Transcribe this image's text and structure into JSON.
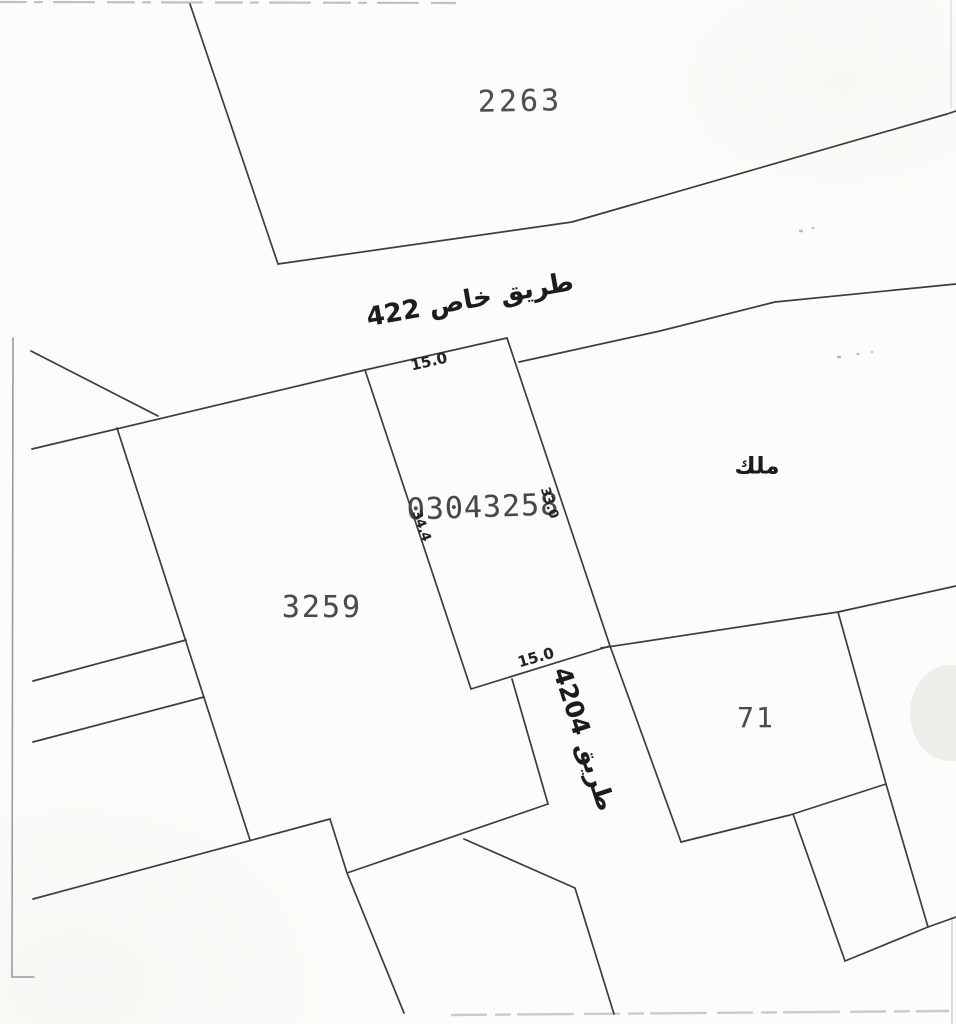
{
  "document": {
    "type": "cadastral-survey-sketch",
    "background": "#fcfcfa",
    "line_color": "#3d3d3d",
    "line_width": 1.7,
    "artifact_color": "#8e8e8e"
  },
  "map": {
    "parcels": [
      {
        "id": "2263"
      },
      {
        "id": "3259"
      },
      {
        "id": "71"
      },
      {
        "id": "03043258"
      }
    ],
    "roads": [
      {
        "label_ar": "طريق خاص",
        "number": "422"
      },
      {
        "label_ar": "طريق",
        "number": "4204"
      }
    ],
    "ownership_note_ar": "ملك",
    "dimensions_m": {
      "top": "15.0",
      "bottom": "15.0",
      "west": "34.4",
      "east": "33.0"
    },
    "labels": [
      {
        "name": "parcel-2263-label",
        "text": "2263",
        "x": 520,
        "y": 102,
        "rotate": -1,
        "size": 30,
        "spacing": 3,
        "color": "#4f4f4f",
        "mono": true
      },
      {
        "name": "road-422-label",
        "text": "طريق خاص 422",
        "x": 470,
        "y": 300,
        "rotate": -10,
        "size": 26,
        "bold": true,
        "rtl": true,
        "color": "#1c1c1c"
      },
      {
        "name": "dim-top-width-label",
        "text": "15.0",
        "x": 429,
        "y": 362,
        "rotate": -13,
        "size": 15,
        "bold": true,
        "color": "#222222"
      },
      {
        "name": "parcel-03043258-label",
        "text": "03043258",
        "x": 483,
        "y": 508,
        "rotate": -2,
        "size": 30,
        "spacing": 1,
        "color": "#484848",
        "mono": true
      },
      {
        "name": "dim-west-length-label",
        "text": "34.4",
        "x": 421,
        "y": 526,
        "rotate": 70,
        "size": 13,
        "bold": true,
        "color": "#222222"
      },
      {
        "name": "dim-east-length-label",
        "text": "33.0",
        "x": 549,
        "y": 503,
        "rotate": 72,
        "size": 13,
        "bold": true,
        "color": "#222222"
      },
      {
        "name": "melk-ownership-label",
        "text": "ملك",
        "x": 757,
        "y": 467,
        "rotate": 0,
        "size": 23,
        "bold": true,
        "rtl": true,
        "color": "#1c1c1c"
      },
      {
        "name": "parcel-3259-label",
        "text": "3259",
        "x": 322,
        "y": 608,
        "rotate": 0,
        "size": 30,
        "spacing": 2,
        "color": "#4b4b4b",
        "mono": true
      },
      {
        "name": "dim-bottom-width-label",
        "text": "15.0",
        "x": 536,
        "y": 658,
        "rotate": -16,
        "size": 15,
        "bold": true,
        "color": "#222222"
      },
      {
        "name": "road-4204-label",
        "text": "طريق 4204",
        "x": 584,
        "y": 739,
        "rotate": 72,
        "size": 25,
        "bold": true,
        "rtl": true,
        "color": "#1c1c1c"
      },
      {
        "name": "parcel-71-label",
        "text": "71",
        "x": 756,
        "y": 718,
        "rotate": 0,
        "size": 28,
        "spacing": 2,
        "color": "#4b4b4b",
        "mono": true
      }
    ],
    "boundaries": [
      {
        "name": "parcel-2263-west-edge",
        "points": [
          [
            190,
            4
          ],
          [
            278,
            264
          ]
        ]
      },
      {
        "name": "parcel-2263-south-boundary",
        "points": [
          [
            278,
            264
          ],
          [
            572,
            222
          ],
          [
            947,
            114
          ],
          [
            956,
            111
          ]
        ]
      },
      {
        "name": "northwest-spur-line",
        "points": [
          [
            31,
            351
          ],
          [
            158,
            416
          ]
        ]
      },
      {
        "name": "west-block-north-boundary",
        "points": [
          [
            32,
            449
          ],
          [
            365,
            370
          ]
        ]
      },
      {
        "name": "plot-top-edge",
        "points": [
          [
            365,
            370
          ],
          [
            507,
            338
          ]
        ]
      },
      {
        "name": "plot-west-edge",
        "points": [
          [
            365,
            370
          ],
          [
            471,
            689
          ]
        ]
      },
      {
        "name": "plot-east-edge-and-road4204-east",
        "points": [
          [
            507,
            338
          ],
          [
            610,
            646
          ],
          [
            681,
            842
          ]
        ]
      },
      {
        "name": "plot-bottom-edge",
        "points": [
          [
            471,
            689
          ],
          [
            610,
            646
          ]
        ]
      },
      {
        "name": "road422-south-melk-north-boundary",
        "points": [
          [
            519,
            362
          ],
          [
            660,
            331
          ],
          [
            775,
            302
          ],
          [
            956,
            284
          ]
        ]
      },
      {
        "name": "melk-parcel71-boundary",
        "points": [
          [
            601,
            648
          ],
          [
            838,
            612
          ],
          [
            956,
            586
          ]
        ]
      },
      {
        "name": "parcel-71-east-edge",
        "points": [
          [
            838,
            612
          ],
          [
            886,
            784
          ]
        ]
      },
      {
        "name": "parcel-71-south-edge",
        "points": [
          [
            681,
            842
          ],
          [
            790,
            815
          ],
          [
            886,
            784
          ]
        ]
      },
      {
        "name": "south-parcel-east-edge",
        "points": [
          [
            886,
            784
          ],
          [
            928,
            927
          ]
        ]
      },
      {
        "name": "south-parcel-west-edge",
        "points": [
          [
            793,
            814
          ],
          [
            845,
            961
          ]
        ]
      },
      {
        "name": "south-parcel-bottom-edge",
        "points": [
          [
            845,
            961
          ],
          [
            928,
            927
          ]
        ]
      },
      {
        "name": "southeast-edge-line",
        "points": [
          [
            928,
            927
          ],
          [
            956,
            917
          ]
        ]
      },
      {
        "name": "parcel-3259-west-edge",
        "points": [
          [
            117,
            428
          ],
          [
            250,
            840
          ]
        ]
      },
      {
        "name": "west-corridor-north-line",
        "points": [
          [
            33,
            681
          ],
          [
            186,
            640
          ]
        ]
      },
      {
        "name": "west-corridor-south-line",
        "points": [
          [
            33,
            742
          ],
          [
            204,
            697
          ]
        ]
      },
      {
        "name": "southwest-boundary",
        "points": [
          [
            33,
            899
          ],
          [
            330,
            819
          ]
        ]
      },
      {
        "name": "south-block-east-descent",
        "points": [
          [
            330,
            819
          ],
          [
            347,
            873
          ],
          [
            404,
            1013
          ]
        ]
      },
      {
        "name": "south-block-north-boundary",
        "points": [
          [
            347,
            873
          ],
          [
            548,
            804
          ]
        ]
      },
      {
        "name": "road-4204-west-edge",
        "points": [
          [
            512,
            679
          ],
          [
            548,
            804
          ]
        ]
      },
      {
        "name": "road-4204-west-lower-edge",
        "points": [
          [
            464,
            839
          ],
          [
            575,
            888
          ],
          [
            614,
            1014
          ]
        ]
      }
    ],
    "artifacts": [
      {
        "name": "scan-top-edge",
        "points": [
          [
            0,
            2
          ],
          [
            455,
            3
          ]
        ],
        "color": "#8e8e8e",
        "width": 2.2,
        "dash": "26 9 7 12 40 14",
        "opacity": 0.55
      },
      {
        "name": "scan-left-border",
        "points": [
          [
            13,
            338
          ],
          [
            12,
            977
          ],
          [
            34,
            977
          ]
        ],
        "color": "#8a8a8a",
        "width": 1.6,
        "dash": "",
        "opacity": 0.85
      },
      {
        "name": "scan-bottom-edge",
        "points": [
          [
            452,
            1015
          ],
          [
            948,
            1011
          ]
        ],
        "color": "#9a9a9a",
        "width": 2.4,
        "dash": "34 10 14 8 55 12",
        "opacity": 0.5
      },
      {
        "name": "scan-right-border-bottom",
        "points": [
          [
            952,
            917
          ],
          [
            952,
            1024
          ]
        ],
        "color": "#ababab",
        "width": 1.5,
        "dash": "",
        "opacity": 0.55
      },
      {
        "name": "scan-right-border-top",
        "points": [
          [
            951,
            0
          ],
          [
            951,
            108
          ]
        ],
        "color": "#b5b5b5",
        "width": 1.3,
        "dash": "",
        "opacity": 0.4
      }
    ],
    "smudges": [
      {
        "name": "scan-blob-right",
        "cx": 950,
        "cy": 713,
        "rx": 40,
        "ry": 48,
        "fill": "#ebebe7",
        "opacity": 0.9
      },
      {
        "name": "speck-1",
        "cx": 801,
        "cy": 231,
        "rx": 2.0,
        "ry": 1.4,
        "fill": "#8a8a8a",
        "opacity": 0.6
      },
      {
        "name": "speck-2",
        "cx": 813,
        "cy": 228,
        "rx": 1.6,
        "ry": 1.2,
        "fill": "#8a8a8a",
        "opacity": 0.5
      },
      {
        "name": "speck-3",
        "cx": 839,
        "cy": 357,
        "rx": 2.2,
        "ry": 1.4,
        "fill": "#8a8a8a",
        "opacity": 0.6
      },
      {
        "name": "speck-4",
        "cx": 858,
        "cy": 354,
        "rx": 1.8,
        "ry": 1.3,
        "fill": "#8a8a8a",
        "opacity": 0.5
      },
      {
        "name": "speck-5",
        "cx": 872,
        "cy": 352,
        "rx": 1.5,
        "ry": 1.2,
        "fill": "#8a8a8a",
        "opacity": 0.45
      }
    ]
  }
}
